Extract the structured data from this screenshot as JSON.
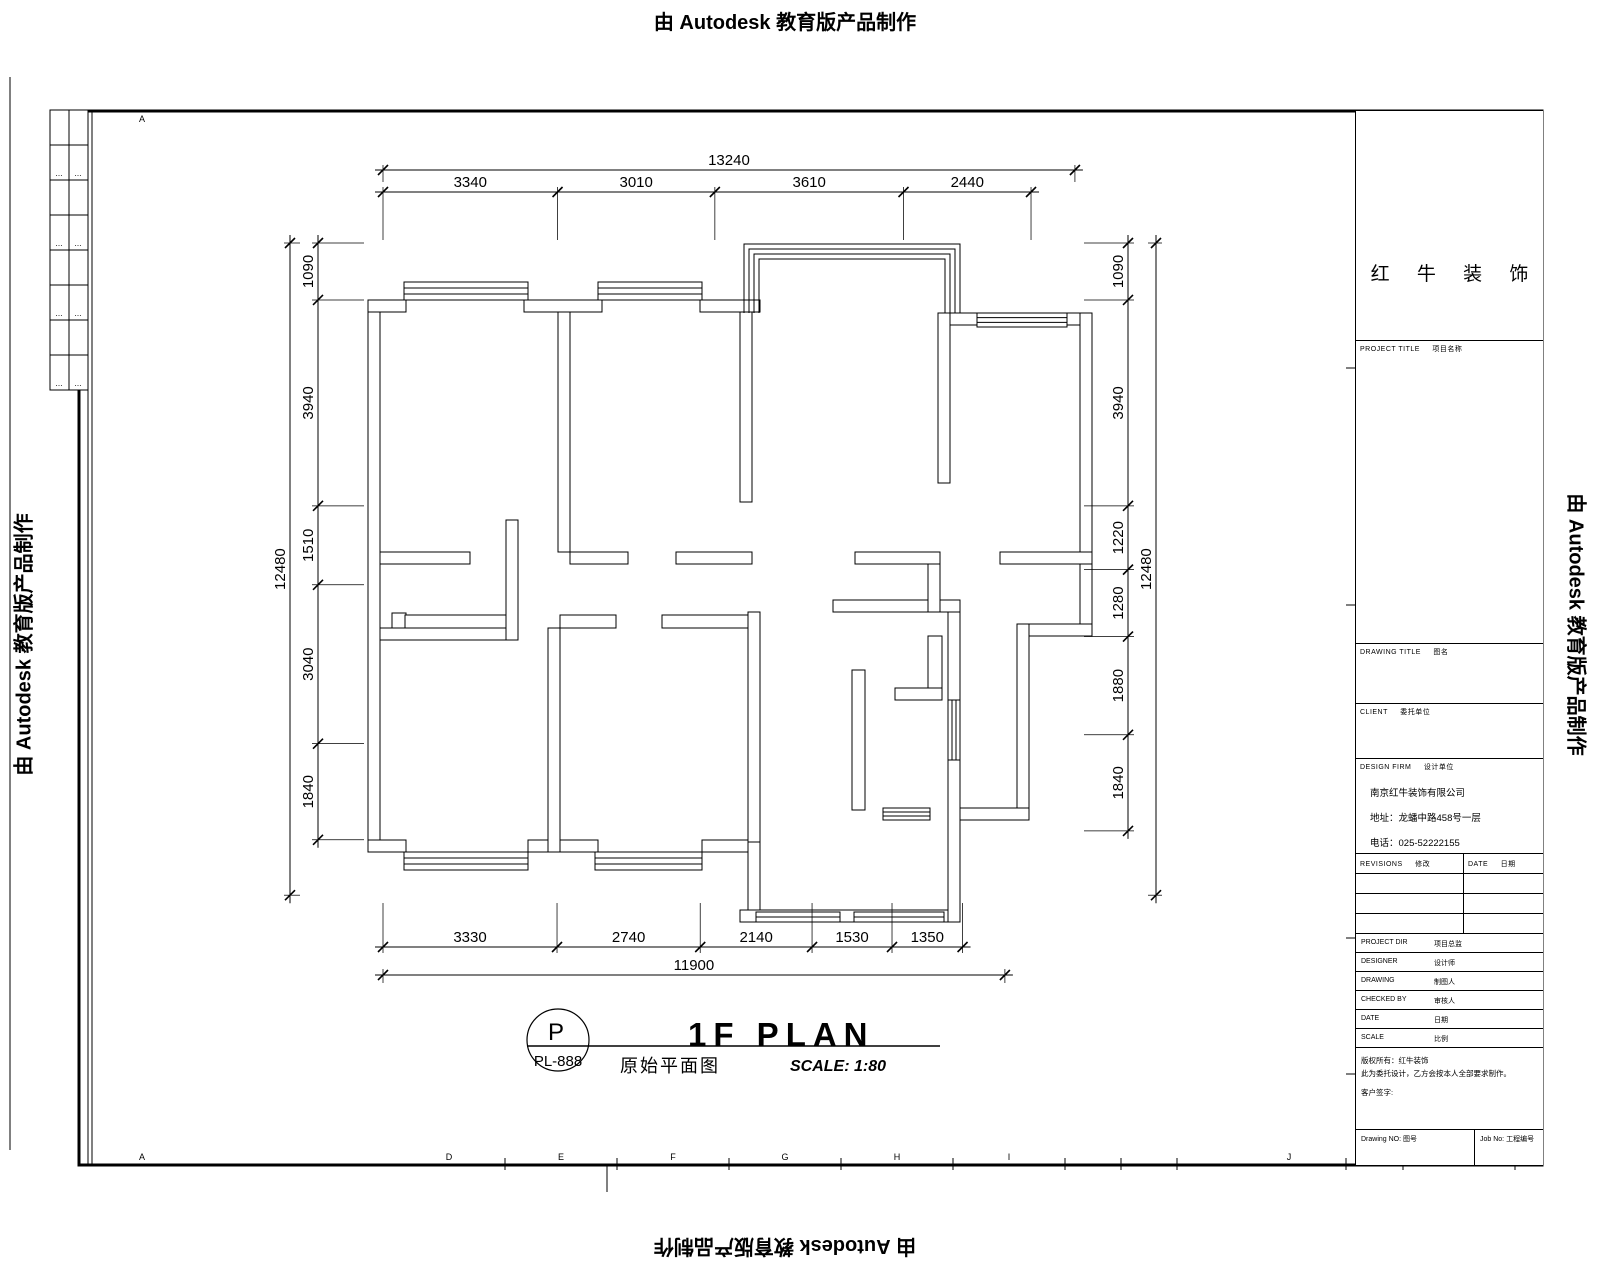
{
  "watermark": {
    "text": "由 Autodesk 教育版产品制作"
  },
  "plan_title": {
    "main": "1F PLAN",
    "scale": "SCALE: 1:80",
    "chinese": "原始平面图"
  },
  "title_mark": {
    "circle_top": "P",
    "circle_bottom": "PL-888"
  },
  "title_block": {
    "logo_text": "红 牛 装 饰",
    "project_title": {
      "en": "PROJECT TITLE",
      "zh": "项目名称"
    },
    "drawing_title": {
      "en": "DRAWING TITLE",
      "zh": "图名"
    },
    "client": {
      "en": "CLIENT",
      "zh": "委托单位"
    },
    "design_firm": {
      "en": "DESIGN FIRM",
      "zh": "设计单位"
    },
    "firm": {
      "company": "南京红牛装饰有限公司",
      "address": "地址：龙蟠中路458号一层",
      "phone": "电话：025-52222155"
    },
    "revisions": {
      "en": "REVISIONS",
      "zh": "修改",
      "date_en": "DATE",
      "date_zh": "日期"
    },
    "staff": [
      {
        "en": "PROJECT DIR",
        "zh": "项目总监"
      },
      {
        "en": "DESIGNER",
        "zh": "设计师"
      },
      {
        "en": "DRAWING",
        "zh": "制图人"
      },
      {
        "en": "CHECKED BY",
        "zh": "审核人"
      },
      {
        "en": "DATE",
        "zh": "日期"
      },
      {
        "en": "SCALE",
        "zh": "比例"
      }
    ],
    "notes": {
      "line1": "版权所有：红牛装饰",
      "line2": "此为委托设计，乙方会按本人全部要求制作。",
      "line3": "客户签字:"
    },
    "drawing_no": {
      "en": "Drawing NO:",
      "zh": "图号"
    },
    "job_no": {
      "en": "Job No:",
      "zh": "工程编号"
    }
  },
  "frame": {
    "top_letters": [
      {
        "t": "A",
        "x": 142
      }
    ],
    "bottom_letters": [
      {
        "t": "A",
        "x": 142
      },
      {
        "t": "D",
        "x": 449
      },
      {
        "t": "E",
        "x": 561
      },
      {
        "t": "F",
        "x": 673
      },
      {
        "t": "G",
        "x": 785
      },
      {
        "t": "H",
        "x": 897
      },
      {
        "t": "I",
        "x": 1009
      },
      {
        "t": "J",
        "x": 1289
      },
      {
        "t": "K",
        "x": 1459
      }
    ],
    "bottom_ticks": [
      505,
      617,
      729,
      841,
      953,
      1065,
      1121,
      1177,
      1346,
      1403,
      1515
    ],
    "rev_strip_marks": [
      "⋯",
      "⋯",
      "⋯",
      "⋯",
      "⋯",
      "⋯",
      "⋯",
      "⋯"
    ]
  },
  "plan": {
    "scale_px_per_mm": 0.05226,
    "walls": [
      [
        368,
        300,
        12,
        552
      ],
      [
        368,
        300,
        38,
        12
      ],
      [
        524,
        300,
        78,
        12
      ],
      [
        700,
        300,
        60,
        12
      ],
      [
        938,
        313,
        39,
        12
      ],
      [
        1067,
        313,
        25,
        12
      ],
      [
        1080,
        313,
        12,
        323
      ],
      [
        1017,
        624,
        75,
        12
      ],
      [
        1017,
        624,
        12,
        196
      ],
      [
        948,
        808,
        81,
        12
      ],
      [
        368,
        840,
        38,
        12
      ],
      [
        528,
        840,
        70,
        12
      ],
      [
        702,
        840,
        58,
        12
      ],
      [
        748,
        840,
        12,
        82
      ],
      [
        740,
        910,
        220,
        12
      ],
      [
        948,
        612,
        12,
        310
      ],
      [
        558,
        312,
        12,
        240
      ],
      [
        740,
        312,
        12,
        190
      ],
      [
        380,
        552,
        90,
        12
      ],
      [
        506,
        520,
        12,
        120
      ],
      [
        570,
        552,
        58,
        12
      ],
      [
        676,
        552,
        76,
        12
      ],
      [
        392,
        613,
        14,
        15
      ],
      [
        405,
        615,
        101,
        13
      ],
      [
        380,
        628,
        126,
        12
      ],
      [
        548,
        628,
        12,
        224
      ],
      [
        560,
        615,
        56,
        13
      ],
      [
        662,
        615,
        88,
        13
      ],
      [
        748,
        612,
        12,
        230
      ],
      [
        833,
        600,
        127,
        12
      ],
      [
        852,
        670,
        13,
        140
      ],
      [
        928,
        636,
        14,
        64
      ],
      [
        895,
        688,
        47,
        12
      ],
      [
        928,
        552,
        12,
        60
      ],
      [
        855,
        552,
        85,
        12
      ],
      [
        1000,
        552,
        92,
        12
      ],
      [
        938,
        313,
        12,
        170
      ]
    ],
    "windows": [
      [
        404,
        282,
        124,
        18,
        4
      ],
      [
        598,
        282,
        104,
        18,
        4
      ],
      [
        977,
        313,
        90,
        14,
        4
      ],
      [
        404,
        852,
        124,
        18,
        4
      ],
      [
        595,
        852,
        107,
        18,
        4
      ],
      [
        756,
        912,
        84,
        10,
        3
      ],
      [
        854,
        912,
        90,
        10,
        3
      ],
      [
        883,
        808,
        47,
        12,
        4
      ],
      [
        948,
        700,
        12,
        60,
        4
      ]
    ],
    "balcony": [
      [
        [
          744,
          313
        ],
        [
          744,
          244
        ],
        [
          960,
          244
        ],
        [
          960,
          313
        ]
      ],
      [
        [
          749,
          313
        ],
        [
          749,
          249
        ],
        [
          955,
          249
        ],
        [
          955,
          313
        ]
      ],
      [
        [
          754,
          313
        ],
        [
          754,
          254
        ],
        [
          950,
          254
        ],
        [
          950,
          313
        ]
      ],
      [
        [
          759,
          313
        ],
        [
          759,
          259
        ],
        [
          945,
          259
        ],
        [
          945,
          313
        ]
      ]
    ],
    "dims": [
      {
        "dir": "h",
        "pos": 170,
        "start": 383,
        "segs": [
          13240
        ],
        "ext": [
          -5,
          12
        ]
      },
      {
        "dir": "h",
        "pos": 192,
        "start": 383,
        "segs": [
          3340,
          3010,
          3610,
          2440
        ],
        "ext": [
          -5,
          48
        ]
      },
      {
        "dir": "h",
        "pos": 947,
        "start": 383,
        "segs": [
          3330,
          2740,
          2140,
          1530,
          1350
        ],
        "ext": [
          -44,
          6
        ]
      },
      {
        "dir": "h",
        "pos": 975,
        "start": 383,
        "segs": [
          11900
        ],
        "ext": [
          -6,
          8
        ]
      },
      {
        "dir": "v",
        "pos": 318,
        "start": 243,
        "segs": [
          1090,
          3940,
          1510,
          3040,
          1840
        ],
        "ext": [
          -6,
          46
        ]
      },
      {
        "dir": "v",
        "pos": 290,
        "start": 243,
        "segs": [
          12480
        ],
        "ext": [
          -6,
          10
        ]
      },
      {
        "dir": "v",
        "pos": 1128,
        "start": 243,
        "segs": [
          1090,
          3940,
          1220,
          1280,
          1880,
          1840
        ],
        "ext": [
          -44,
          6
        ]
      },
      {
        "dir": "v",
        "pos": 1156,
        "start": 243,
        "segs": [
          12480
        ],
        "ext": [
          -8,
          6
        ]
      }
    ]
  }
}
